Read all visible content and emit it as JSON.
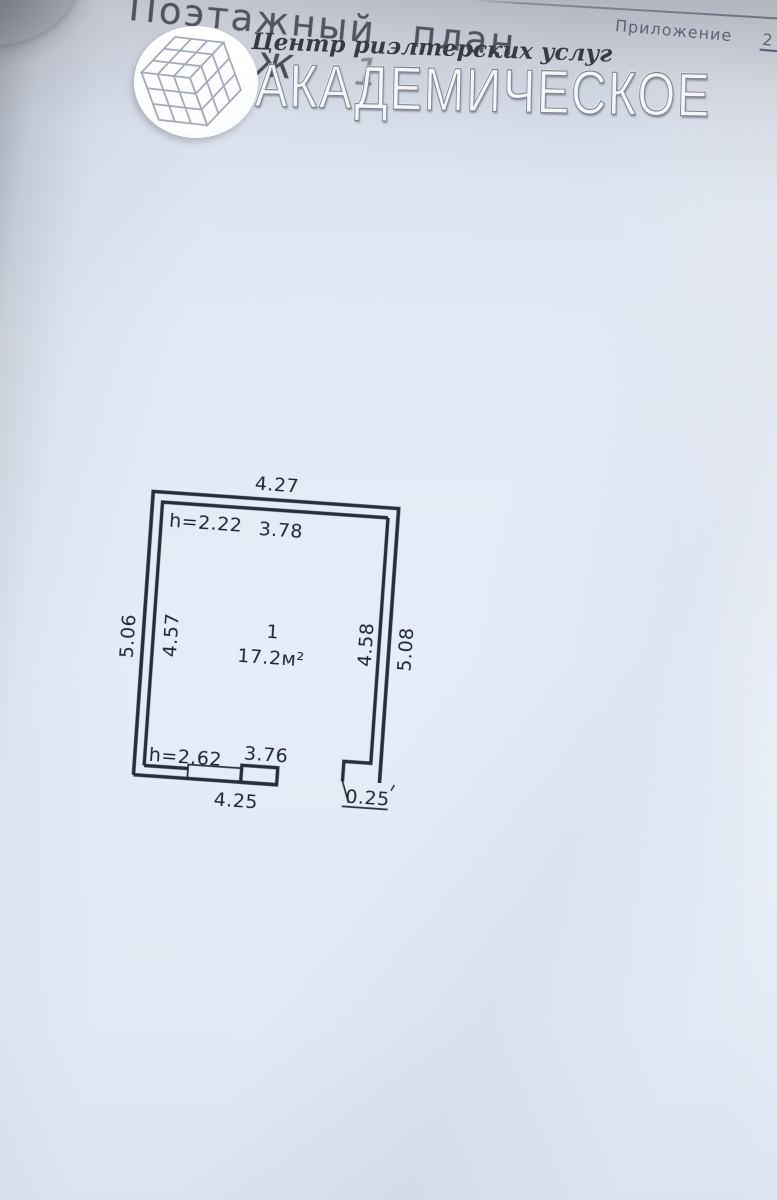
{
  "document": {
    "appendix": {
      "label": "Приложение",
      "number": "2"
    },
    "handwritten": {
      "title": "Поэтажный план",
      "floor_partial": "аж",
      "floor_number": "1"
    }
  },
  "watermark": {
    "tagline": "Центр риэлтерских услуг",
    "brand": "АКАДЕМИЧЕСКОЕ"
  },
  "floor_plan": {
    "room_number": "1",
    "room_area": "17.2м²",
    "dims": {
      "top_outer": "4.27",
      "ceiling_height_top": "h=2.22",
      "top_inner": "3.78",
      "left_outer": "5.06",
      "left_inner": "4.57",
      "right_inner": "4.58",
      "right_outer": "5.08",
      "ceiling_height_bottom": "h=2.62",
      "bottom_inner": "3.76",
      "bottom_outer": "4.25",
      "wall_step": "0.25"
    },
    "ink_color": "#272d3a",
    "paper_color": "#e5ebf6"
  }
}
